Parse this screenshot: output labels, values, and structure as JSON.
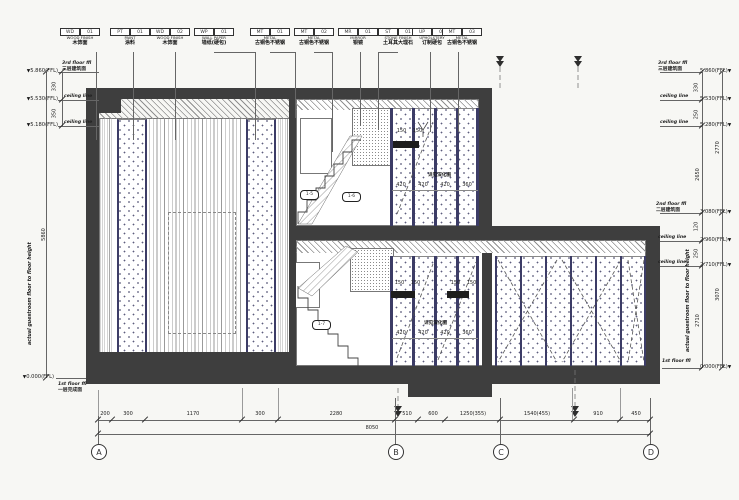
{
  "drawing": {
    "title": "guestroom elevation",
    "material_tags": [
      {
        "c1": "WD",
        "c2": "01",
        "en": "WOOD FINISH",
        "zh": "木饰面"
      },
      {
        "c1": "PT",
        "c2": "01",
        "en": "PAINT",
        "zh": "涂料"
      },
      {
        "c1": "WD",
        "c2": "02",
        "en": "WOOD FINISH",
        "zh": "木饰面"
      },
      {
        "c1": "WP",
        "c2": "01",
        "en": "WALL PAPER",
        "zh": "墙纸(硬包)"
      },
      {
        "c1": "MT",
        "c2": "01",
        "en": "METAL",
        "zh": "古铜色不锈钢"
      },
      {
        "c1": "MT",
        "c2": "02",
        "en": "METAL",
        "zh": "古铜色不锈钢"
      },
      {
        "c1": "MR",
        "c2": "01",
        "en": "MIRROR",
        "zh": "银镜"
      },
      {
        "c1": "ST",
        "c2": "01",
        "en": "STONE FINISH",
        "zh": "土耳其大理石"
      },
      {
        "c1": "UP",
        "c2": "01",
        "en": "UPHOLSTERY",
        "zh": "订制硬包"
      },
      {
        "c1": "MT",
        "c2": "03",
        "en": "METAL",
        "zh": "古铜色不锈钢"
      }
    ],
    "elev_left": {
      "rows": [
        {
          "value": "5.860(FFL)",
          "en": "3rd floor ffl",
          "zh": "三层建筑面"
        },
        {
          "value": "5.530(FFL)",
          "en": "ceiling line",
          "zh": ""
        },
        {
          "value": "5.180(FFL)",
          "en": "ceiling line",
          "zh": ""
        }
      ],
      "dims": [
        "330",
        "350"
      ],
      "long_dim": "5860",
      "note": "actual guestroom floor to floor height",
      "bottom": {
        "value": "0.000(FFL)",
        "en": "1st floor ffl",
        "zh": "一层完成面"
      }
    },
    "elev_right": {
      "top_rows": [
        {
          "value": "5.860(FFL)",
          "en": "3rd floor ffl",
          "zh": "三层建筑面"
        },
        {
          "value": "5.530(FFL)",
          "en": "ceiling line",
          "zh": ""
        },
        {
          "value": "5.280(FFL)",
          "en": "ceiling line",
          "zh": ""
        }
      ],
      "top_dims": [
        "330",
        "250"
      ],
      "top_inner": "2650",
      "top_outer": "2770",
      "mid_rows": [
        {
          "value": "3.080(FFL)",
          "en": "2nd floor ffl",
          "zh": "二层建筑面"
        },
        {
          "value": "2.960(FFL)",
          "en": "ceiling line",
          "zh": ""
        },
        {
          "value": "2.710(FFL)",
          "en": "ceiling line",
          "zh": ""
        }
      ],
      "mid_dims": [
        "120",
        "250"
      ],
      "mid_inner": "2710",
      "mid_outer": "3070",
      "note": "actual guestroom floor to floor height",
      "bottom": {
        "value": "0.000(FFL)",
        "en": "1st floor ffl",
        "zh": ""
      }
    },
    "bottom_dims": {
      "row1": [
        "200",
        "300",
        "1170",
        "300",
        "2280",
        "510",
        "600",
        "1250(355)",
        "1540(455)",
        "910",
        "450"
      ],
      "total": "8050"
    },
    "grids": [
      "A",
      "B",
      "C",
      "D"
    ],
    "annotations": {
      "panel_dims": [
        "420",
        "420",
        "420",
        "360"
      ],
      "dim_150_a": "150",
      "dim_150_b": "150",
      "see_detail": "详见深化图",
      "callout_1": "1-5",
      "callout_2": "1-6",
      "callout_3": "1-7"
    },
    "colors": {
      "wall": "#3e3e3e",
      "panel_divider": "#3c3c66",
      "line": "#555555",
      "background": "#f7f7f4"
    }
  }
}
